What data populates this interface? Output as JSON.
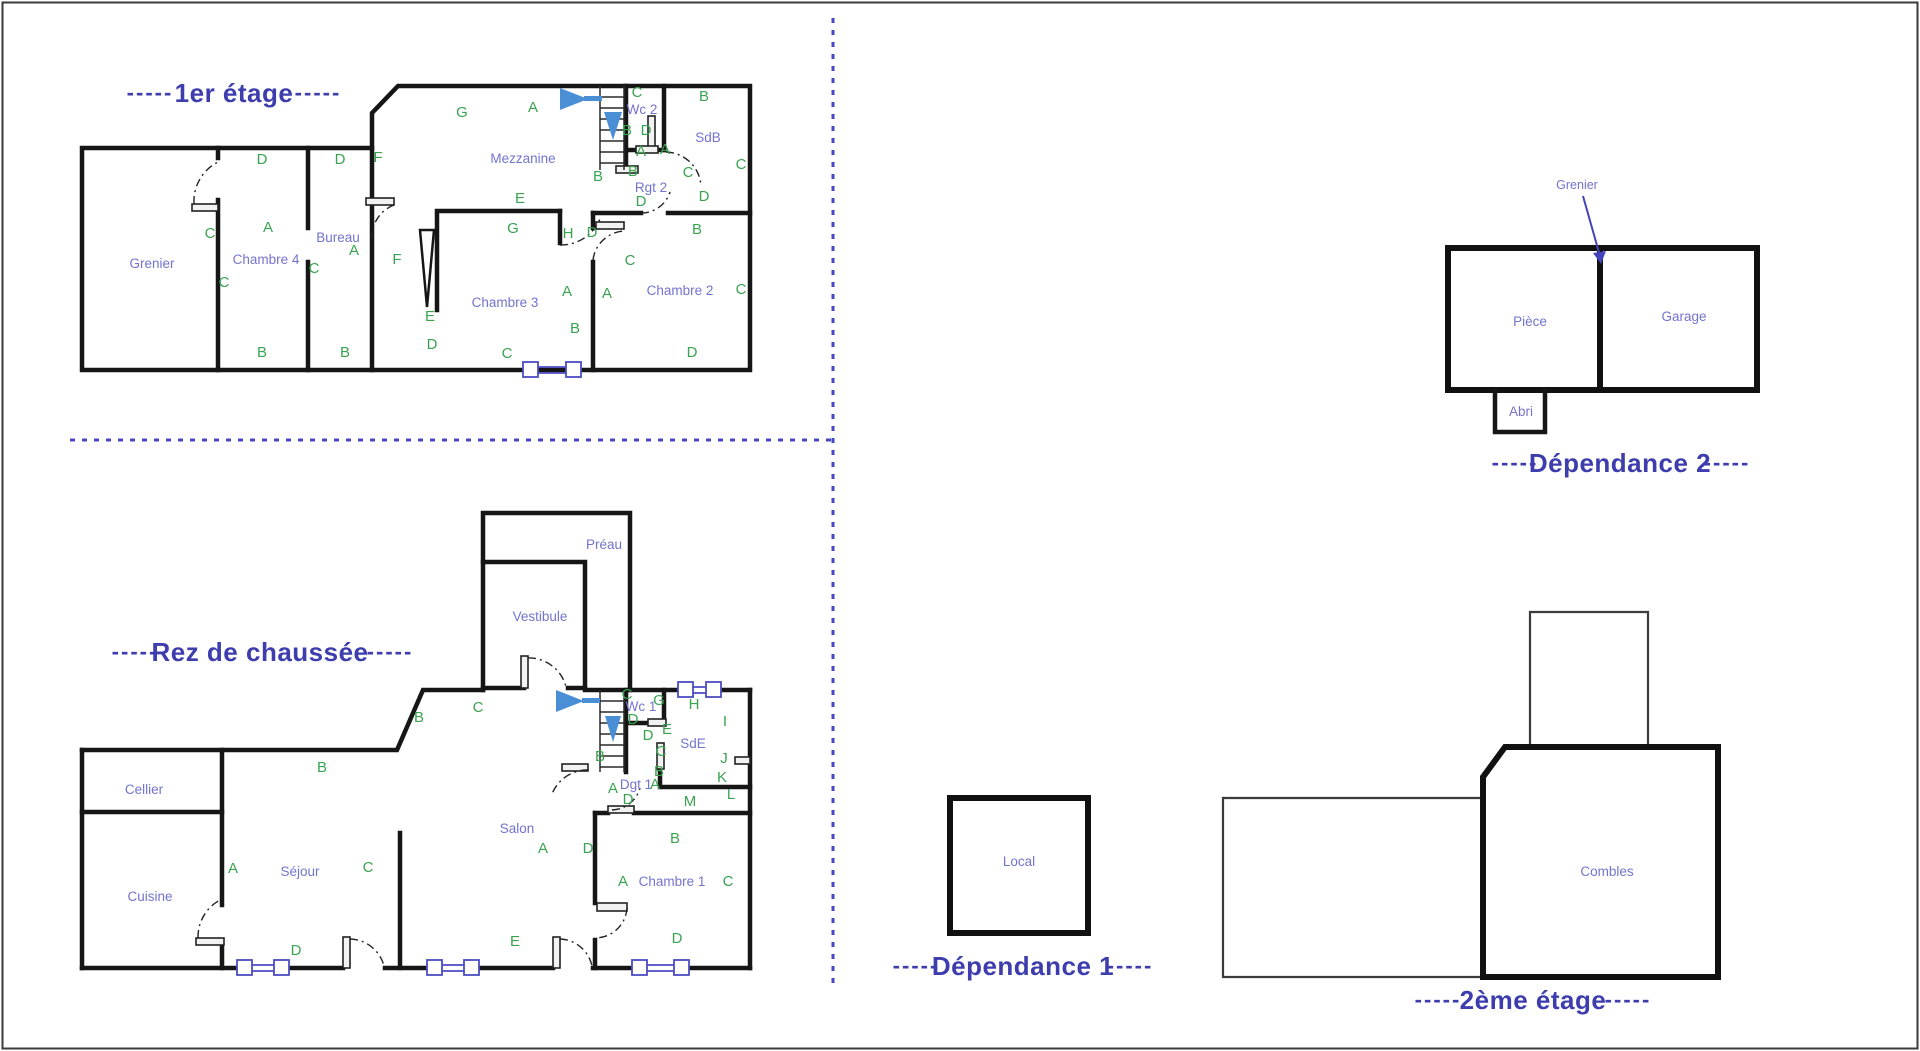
{
  "ui": {
    "title_dash": "-----"
  },
  "colors": {
    "wall": "#161616",
    "title_text": "#3d3dae",
    "room_label": "#7373d0",
    "wall_letter": "#3aa351",
    "window_symbol": "#4c4cc2",
    "separator": "#4646c0",
    "stair_arrow": "#4a8fd6",
    "door_arc": "#222222"
  },
  "plans": {
    "premier_etage": {
      "title": "1er étage",
      "rooms": [
        {
          "t": "Grenier",
          "x": 152,
          "y": 268
        },
        {
          "t": "Chambre 4",
          "x": 266,
          "y": 264
        },
        {
          "t": "Bureau",
          "x": 338,
          "y": 242
        },
        {
          "t": "Mezzanine",
          "x": 523,
          "y": 163
        },
        {
          "t": "Wc 2",
          "x": 642,
          "y": 114
        },
        {
          "t": "SdB",
          "x": 708,
          "y": 142
        },
        {
          "t": "Rgt 2",
          "x": 651,
          "y": 192
        },
        {
          "t": "Chambre 3",
          "x": 505,
          "y": 307
        },
        {
          "t": "Chambre 2",
          "x": 680,
          "y": 295
        }
      ],
      "letters": [
        {
          "t": "D",
          "x": 262,
          "y": 164
        },
        {
          "t": "D",
          "x": 340,
          "y": 164
        },
        {
          "t": "F",
          "x": 378,
          "y": 162
        },
        {
          "t": "G",
          "x": 462,
          "y": 117
        },
        {
          "t": "A",
          "x": 533,
          "y": 112
        },
        {
          "t": "C",
          "x": 210,
          "y": 238
        },
        {
          "t": "A",
          "x": 268,
          "y": 232
        },
        {
          "t": "C",
          "x": 224,
          "y": 287
        },
        {
          "t": "C",
          "x": 314,
          "y": 273
        },
        {
          "t": "A",
          "x": 354,
          "y": 255
        },
        {
          "t": "F",
          "x": 397,
          "y": 264
        },
        {
          "t": "E",
          "x": 430,
          "y": 321
        },
        {
          "t": "D",
          "x": 432,
          "y": 349
        },
        {
          "t": "B",
          "x": 262,
          "y": 357
        },
        {
          "t": "B",
          "x": 345,
          "y": 357
        },
        {
          "t": "E",
          "x": 520,
          "y": 203
        },
        {
          "t": "G",
          "x": 513,
          "y": 233
        },
        {
          "t": "H",
          "x": 568,
          "y": 238
        },
        {
          "t": "D",
          "x": 592,
          "y": 237
        },
        {
          "t": "C",
          "x": 630,
          "y": 265
        },
        {
          "t": "A",
          "x": 567,
          "y": 296
        },
        {
          "t": "A",
          "x": 607,
          "y": 298
        },
        {
          "t": "B",
          "x": 575,
          "y": 333
        },
        {
          "t": "C",
          "x": 507,
          "y": 358
        },
        {
          "t": "B",
          "x": 697,
          "y": 234
        },
        {
          "t": "C",
          "x": 741,
          "y": 294
        },
        {
          "t": "D",
          "x": 692,
          "y": 357
        },
        {
          "t": "B",
          "x": 704,
          "y": 101
        },
        {
          "t": "C",
          "x": 741,
          "y": 169
        },
        {
          "t": "C",
          "x": 637,
          "y": 97
        },
        {
          "t": "B",
          "x": 627,
          "y": 135
        },
        {
          "t": "D",
          "x": 646,
          "y": 135
        },
        {
          "t": "A",
          "x": 641,
          "y": 156
        },
        {
          "t": "A",
          "x": 665,
          "y": 154
        },
        {
          "t": "B",
          "x": 633,
          "y": 176
        },
        {
          "t": "C",
          "x": 688,
          "y": 177
        },
        {
          "t": "B",
          "x": 598,
          "y": 181
        },
        {
          "t": "D",
          "x": 641,
          "y": 206
        },
        {
          "t": "D",
          "x": 704,
          "y": 201
        }
      ]
    },
    "rdc": {
      "title": "Rez de chaussée",
      "rooms": [
        {
          "t": "Cellier",
          "x": 144,
          "y": 794
        },
        {
          "t": "Cuisine",
          "x": 150,
          "y": 901
        },
        {
          "t": "Séjour",
          "x": 300,
          "y": 876
        },
        {
          "t": "Salon",
          "x": 517,
          "y": 833
        },
        {
          "t": "Vestibule",
          "x": 540,
          "y": 621
        },
        {
          "t": "Préau",
          "x": 604,
          "y": 549
        },
        {
          "t": "Wc 1",
          "x": 641,
          "y": 711
        },
        {
          "t": "SdE",
          "x": 693,
          "y": 748
        },
        {
          "t": "Dgt 1",
          "x": 636,
          "y": 789
        },
        {
          "t": "Chambre 1",
          "x": 672,
          "y": 886
        }
      ],
      "letters": [
        {
          "t": "B",
          "x": 322,
          "y": 772
        },
        {
          "t": "B",
          "x": 419,
          "y": 722
        },
        {
          "t": "C",
          "x": 478,
          "y": 712
        },
        {
          "t": "A",
          "x": 233,
          "y": 873
        },
        {
          "t": "C",
          "x": 368,
          "y": 872
        },
        {
          "t": "D",
          "x": 296,
          "y": 955
        },
        {
          "t": "A",
          "x": 543,
          "y": 853
        },
        {
          "t": "D",
          "x": 588,
          "y": 853
        },
        {
          "t": "E",
          "x": 515,
          "y": 946
        },
        {
          "t": "C",
          "x": 627,
          "y": 699
        },
        {
          "t": "G",
          "x": 659,
          "y": 705
        },
        {
          "t": "H",
          "x": 694,
          "y": 709
        },
        {
          "t": "D",
          "x": 633,
          "y": 724
        },
        {
          "t": "E",
          "x": 667,
          "y": 734
        },
        {
          "t": "D",
          "x": 648,
          "y": 740
        },
        {
          "t": "C",
          "x": 661,
          "y": 756
        },
        {
          "t": "I",
          "x": 725,
          "y": 726
        },
        {
          "t": "J",
          "x": 724,
          "y": 763
        },
        {
          "t": "K",
          "x": 722,
          "y": 782
        },
        {
          "t": "L",
          "x": 731,
          "y": 799
        },
        {
          "t": "B",
          "x": 600,
          "y": 761
        },
        {
          "t": "B",
          "x": 659,
          "y": 776
        },
        {
          "t": "A",
          "x": 613,
          "y": 793
        },
        {
          "t": "A",
          "x": 655,
          "y": 789
        },
        {
          "t": "D",
          "x": 628,
          "y": 804
        },
        {
          "t": "M",
          "x": 690,
          "y": 806
        },
        {
          "t": "B",
          "x": 675,
          "y": 843
        },
        {
          "t": "A",
          "x": 623,
          "y": 886
        },
        {
          "t": "C",
          "x": 728,
          "y": 886
        },
        {
          "t": "D",
          "x": 677,
          "y": 943
        }
      ]
    },
    "dependance_2": {
      "title": "Dépendance 2",
      "annotation": [
        {
          "t": "Grenier",
          "x": 1577,
          "y": 189
        }
      ],
      "rooms": [
        {
          "t": "Pièce",
          "x": 1530,
          "y": 326
        },
        {
          "t": "Garage",
          "x": 1684,
          "y": 321
        },
        {
          "t": "Abri",
          "x": 1521,
          "y": 416
        }
      ]
    },
    "dependance_1": {
      "title": "Dépendance 1",
      "rooms": [
        {
          "t": "Local",
          "x": 1019,
          "y": 866
        }
      ]
    },
    "deuxieme_etage": {
      "title": "2ème étage",
      "rooms": [
        {
          "t": "Combles",
          "x": 1607,
          "y": 876
        }
      ]
    }
  }
}
